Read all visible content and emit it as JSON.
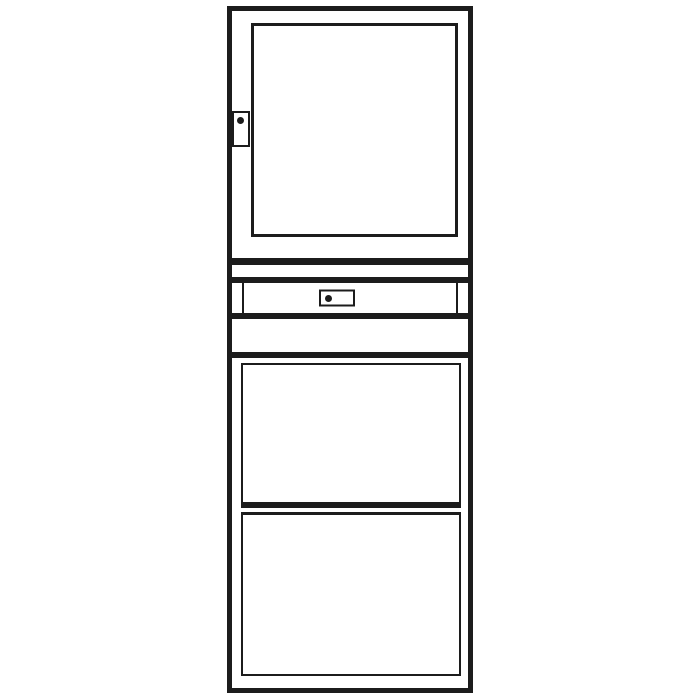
{
  "figure": {
    "type": "technical-line-drawing",
    "subject": "tall storage cabinet, front elevation",
    "sections": [
      {
        "name": "upper-door",
        "features": [
          "inner-panel",
          "left-latch",
          "latch-knob"
        ]
      },
      {
        "name": "spacer-band-upper",
        "features": []
      },
      {
        "name": "drawer",
        "features": [
          "drawer-front",
          "center-handle-plate",
          "handle-knob"
        ]
      },
      {
        "name": "spacer-band-lower",
        "features": []
      },
      {
        "name": "lower-cabinet",
        "features": [
          "upper-panel",
          "lower-panel"
        ]
      }
    ],
    "knob_count": 2,
    "text_labels": []
  },
  "colors": {
    "line": "#1c1c1c",
    "bg": "#ffffff"
  }
}
